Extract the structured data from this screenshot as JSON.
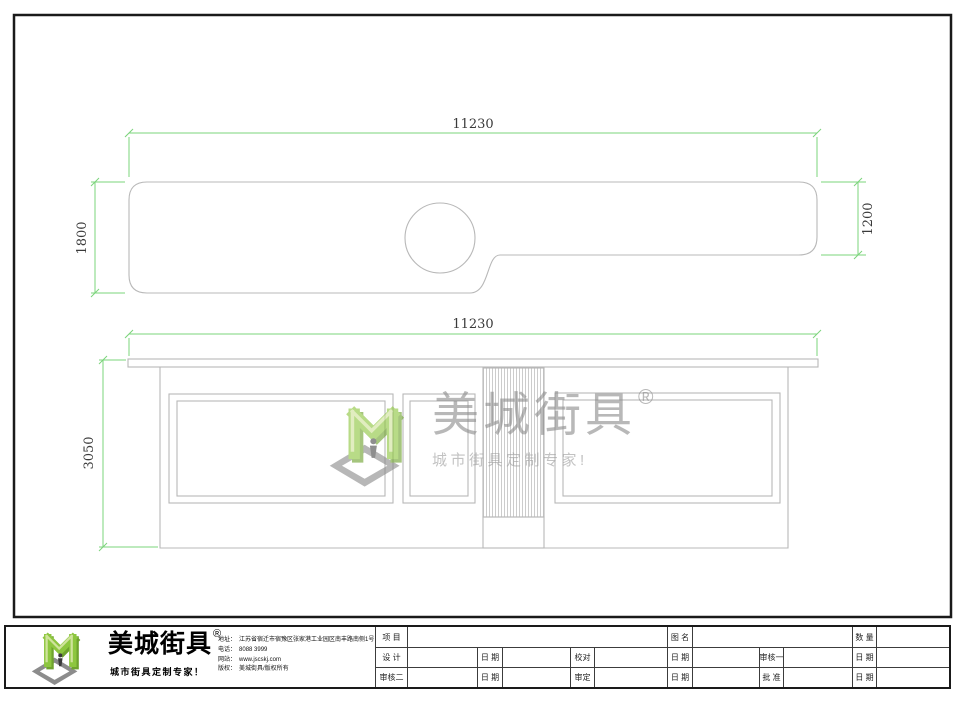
{
  "drawing": {
    "plan": {
      "width": "11230",
      "depth_left": "1800",
      "depth_right": "1200"
    },
    "elevation": {
      "width": "11230",
      "height": "3050"
    },
    "colors": {
      "dimension_green": "#7bd47b",
      "dimension_text": "#3a3a3a",
      "line_gray": "#b8b8b8",
      "frame_dark": "#1a1a1a"
    }
  },
  "watermark": {
    "name": "美城街具",
    "registered": "®",
    "tagline": "城市街具定制专家!"
  },
  "footer": {
    "brand": {
      "name": "美城街具",
      "registered": "®",
      "tagline": "城市街具定制专家！",
      "logo_green": "#8dc63f",
      "logo_green_dark": "#6fa32e",
      "logo_green_light": "#cfe39b",
      "logo_base_gray": "#8c8c8c"
    },
    "company": {
      "address_label": "地址：",
      "address": "江苏省宿迁市宿豫区张家港工业园区南丰路南侧1号",
      "phone_label": "电话：",
      "phone": "8088 3999",
      "website_label": "网站：",
      "website": "www.jscskj.com",
      "copyright_label": "版权：",
      "copyright": "美城街具/版权所有"
    },
    "titleblock": {
      "project": "项 目",
      "drawing_name": "图 名",
      "quantity": "数 量",
      "design": "设 计",
      "date": "日 期",
      "proofread": "校对",
      "reviewer1": "审核一",
      "reviewer2": "审核二",
      "approve": "审定",
      "ratify": "批 准"
    }
  }
}
